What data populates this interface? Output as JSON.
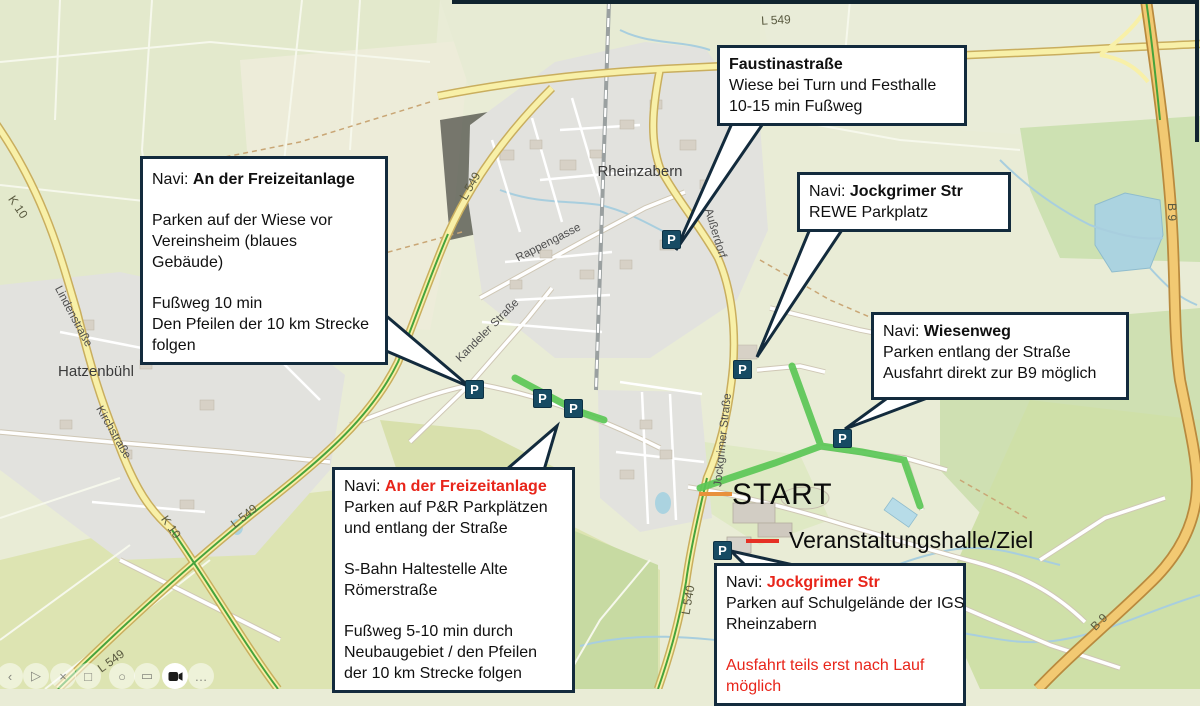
{
  "annotation_boxes": {
    "faustina": {
      "title": "Faustinastraße",
      "lines": [
        "Wiese bei Turn und Festhalle",
        "10-15 min Fußweg"
      ]
    },
    "freizeitanlage": {
      "prefix": "Navi: ",
      "name": "An der Freizeitanlage",
      "lines": [
        "Parken auf der Wiese vor",
        "Vereinsheim (blaues",
        "Gebäude)"
      ],
      "lines2": [
        "Fußweg 10 min",
        "Den Pfeilen der 10 km Strecke",
        "folgen"
      ]
    },
    "rewe": {
      "prefix": "Navi: ",
      "name": "Jockgrimer Str",
      "lines": [
        "REWE Parkplatz"
      ]
    },
    "wiesenweg": {
      "prefix": "Navi: ",
      "name": "Wiesenweg",
      "lines": [
        "Parken entlang der Straße",
        "Ausfahrt direkt zur B9 möglich"
      ]
    },
    "freizeitanlage_pr": {
      "prefix": "Navi: ",
      "name": "An der Freizeitanlage",
      "lines": [
        "Parken auf P&R Parkplätzen",
        "und entlang der Straße"
      ],
      "lines2": [
        "S-Bahn Haltestelle Alte",
        "Römerstraße"
      ],
      "lines3": [
        "Fußweg 5-10 min durch",
        "Neubaugebiet / den Pfeilen",
        "der 10 km Strecke folgen"
      ]
    },
    "igs": {
      "prefix": "Navi: ",
      "name": "Jockgrimer Str",
      "lines": [
        "Parken auf Schulgelände der IGS",
        "Rheinzabern"
      ],
      "warning": [
        "Ausfahrt teils erst nach Lauf",
        "möglich"
      ]
    }
  },
  "markers": {
    "start": "START",
    "finish": "Veranstaltungshalle/Ziel",
    "parking": "P"
  },
  "map": {
    "labels": [
      "Rheinzabern",
      "Hatzenbühl",
      "Rappengasse",
      "Außerdorf",
      "Kandeler Straße",
      "Jockgrimer Straße",
      "Lindenstraße",
      "Kirchstraße",
      "K 10",
      "K 10",
      "L 549",
      "L 549",
      "L 549",
      "L 549",
      "L 540",
      "B 9",
      "B 9"
    ]
  },
  "toolbar": {
    "icons": [
      "‹",
      "▷",
      "×",
      "□",
      "○",
      "▭"
    ],
    "more": "…"
  },
  "colors": {
    "callout_border": "#132b3d",
    "warning_red": "#e8251a",
    "route_green": "#5bc756",
    "parking_blue": "#174b63",
    "start_dash_orange": "#e8913c",
    "finish_dash_red": "#e63125",
    "road_yellow": "#f8f0a8",
    "road_b9_orange": "#f2c972",
    "water_blue": "#abd3e0"
  }
}
